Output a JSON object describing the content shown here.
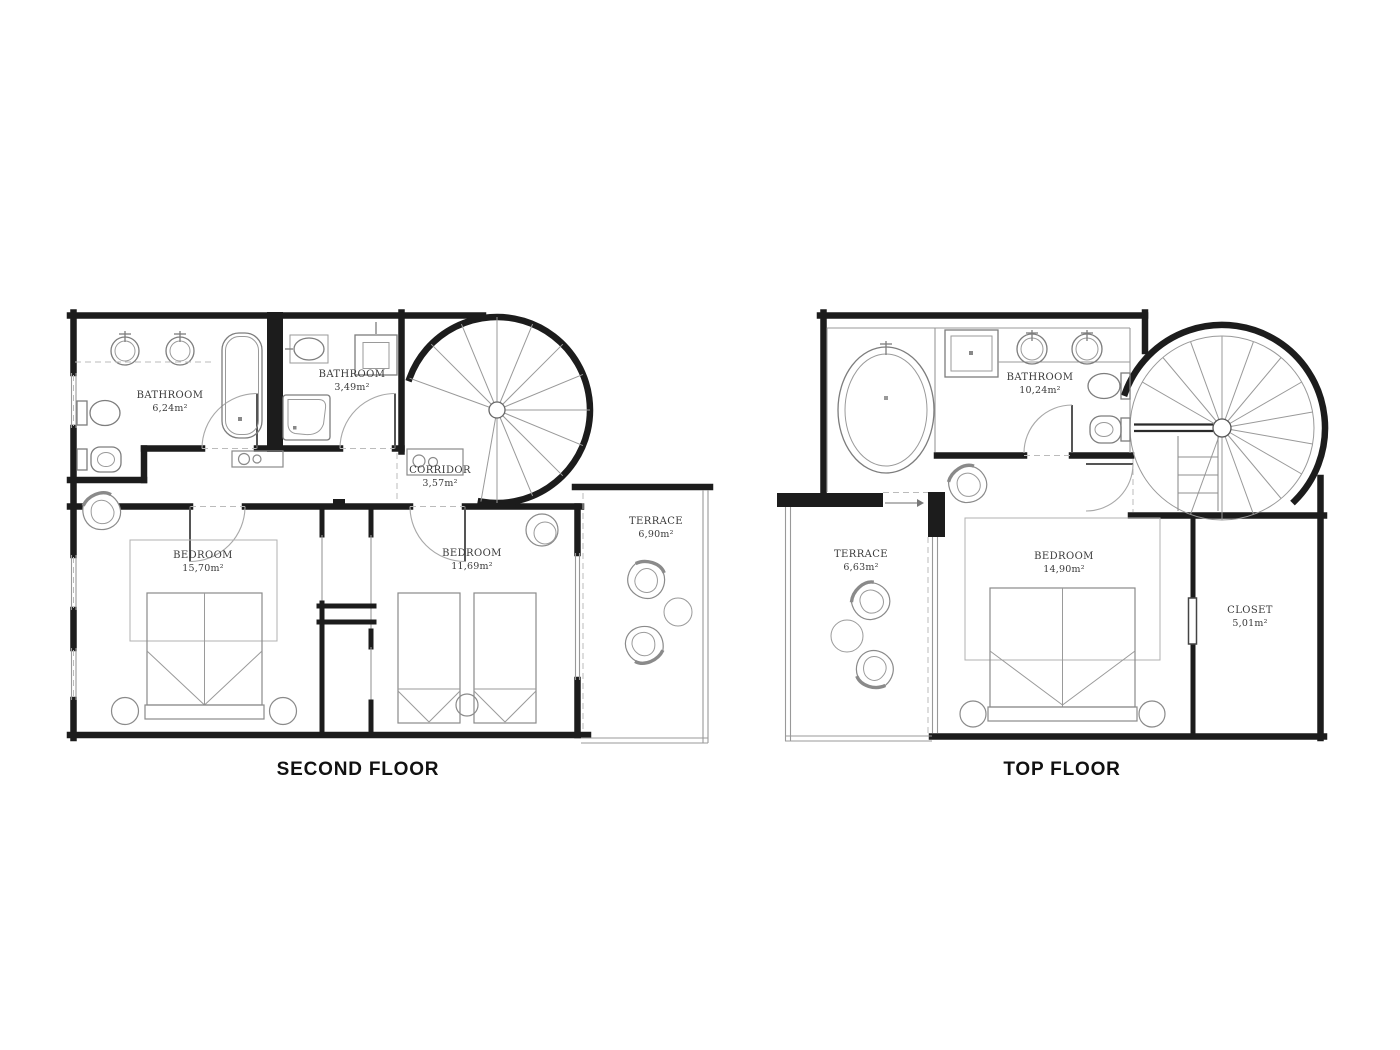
{
  "page": {
    "background": "#ffffff"
  },
  "colors": {
    "wall": "#1c1c1c",
    "fixture": "#7d7d7d",
    "furniture": "#9a9a9a",
    "dashed": "#bbbbbb",
    "label_text": "#3a3a3a",
    "title_text": "#111111"
  },
  "floors": [
    {
      "title": "SECOND FLOOR",
      "rooms": [
        {
          "name": "BATHROOM",
          "area": "6,24m²"
        },
        {
          "name": "BATHROOM",
          "area": "3,49m²"
        },
        {
          "name": "CORRIDOR",
          "area": "3,57m²"
        },
        {
          "name": "BEDROOM",
          "area": "15,70m²"
        },
        {
          "name": "BEDROOM",
          "area": "11,69m²"
        },
        {
          "name": "TERRACE",
          "area": "6,90m²"
        }
      ]
    },
    {
      "title": "TOP FLOOR",
      "rooms": [
        {
          "name": "BATHROOM",
          "area": "10,24m²"
        },
        {
          "name": "TERRACE",
          "area": "6,63m²"
        },
        {
          "name": "BEDROOM",
          "area": "14,90m²"
        },
        {
          "name": "CLOSET",
          "area": "5,01m²"
        }
      ]
    }
  ]
}
